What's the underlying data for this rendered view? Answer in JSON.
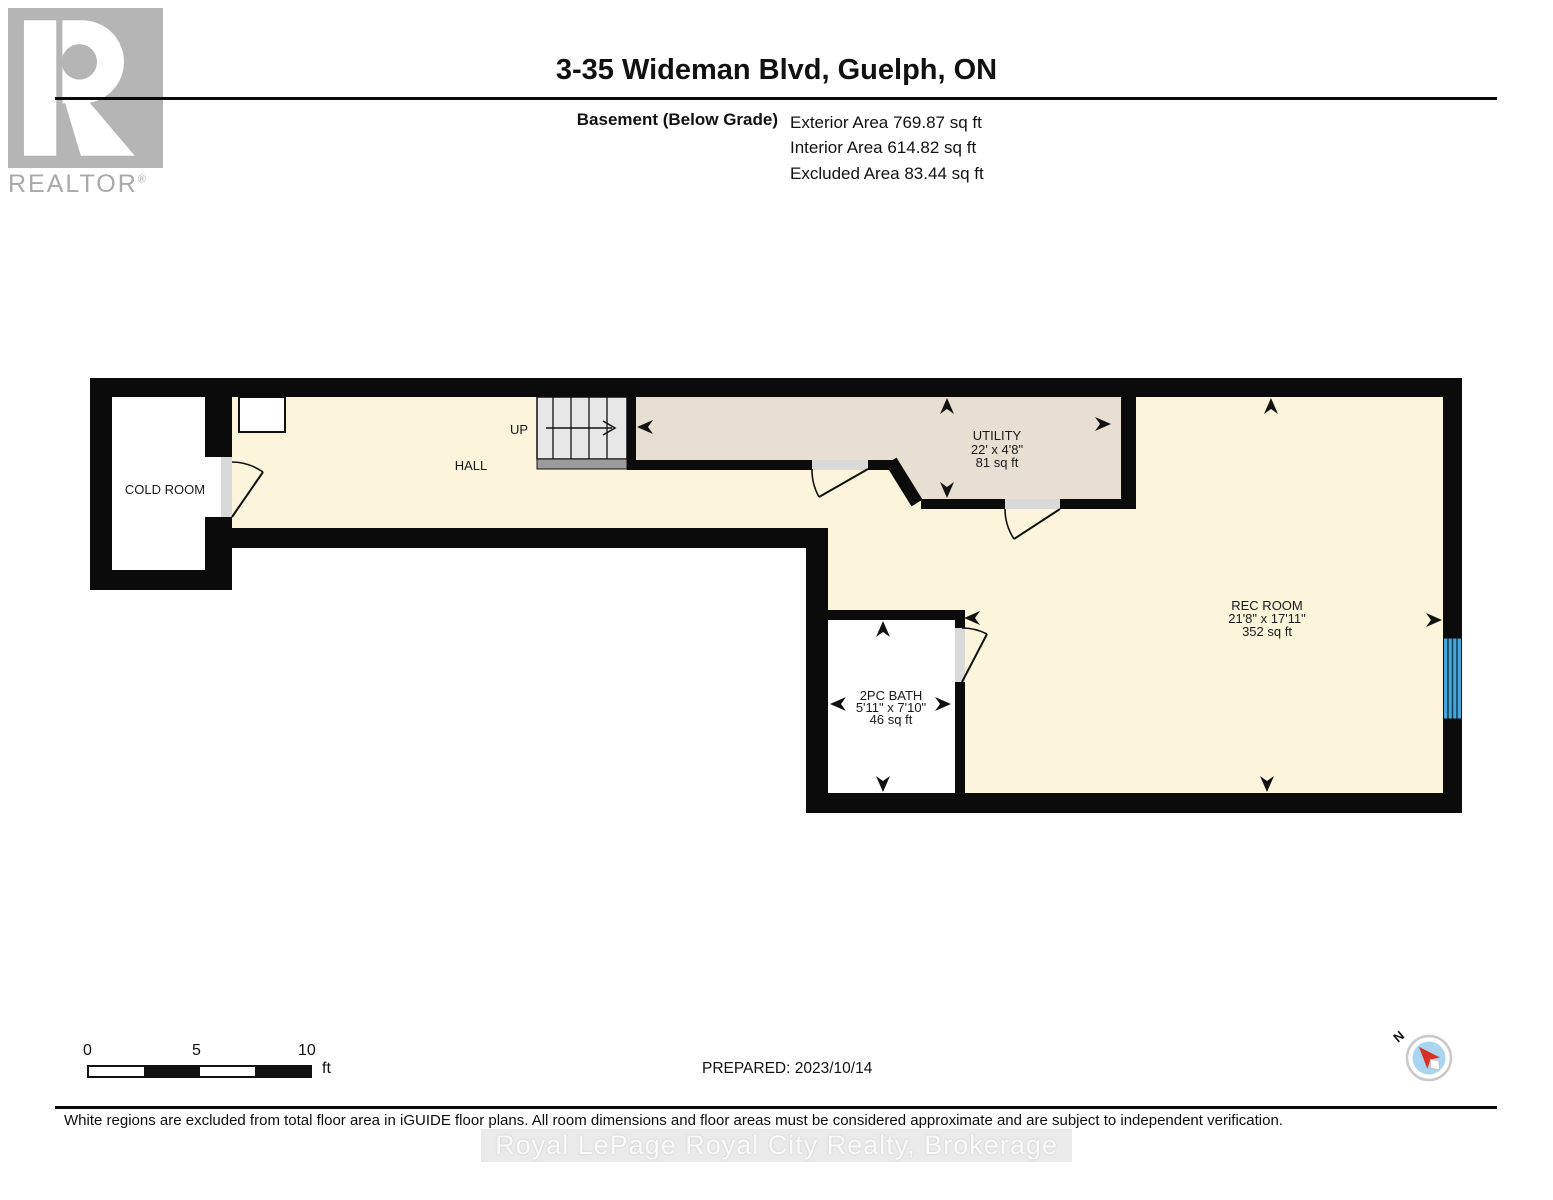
{
  "logo": {
    "text": "REALTOR",
    "reg": "®"
  },
  "header": {
    "title": "3-35 Wideman Blvd, Guelph, ON",
    "floor_label": "Basement (Below Grade)",
    "area_lines": [
      "Exterior Area 769.87 sq ft",
      "Interior Area 614.82 sq ft",
      "Excluded Area 83.44 sq ft"
    ]
  },
  "plan": {
    "rooms": {
      "cold_room": {
        "name": "COLD ROOM"
      },
      "hall": {
        "name": "HALL"
      },
      "stairs": {
        "label": "UP"
      },
      "utility": {
        "name": "UTILITY",
        "dims": "22' x 4'8\"",
        "area": "81 sq ft"
      },
      "rec_room": {
        "name": "REC ROOM",
        "dims": "21'8\" x 17'11\"",
        "area": "352 sq ft"
      },
      "bath": {
        "name": "2PC BATH",
        "dims": "5'11\" x 7'10\"",
        "area": "46 sq ft"
      }
    },
    "colors": {
      "floor": "#fcf5dc",
      "utility_floor": "#e8dfd3",
      "wall": "#0b0b0b",
      "stairs": "#e7e7e7",
      "stair_base": "#9b9b9b",
      "window_blue": "#45a6db",
      "door_sill": "#d9d9d9",
      "compass_red": "#d93025",
      "compass_blue": "#aad5ef"
    }
  },
  "scale_bar": {
    "ticks": [
      "0",
      "5",
      "10"
    ],
    "unit": "ft"
  },
  "prepared_label": "PREPARED: 2023/10/14",
  "compass": {
    "north_label": "N"
  },
  "footer": {
    "disclaimer": "White regions are excluded from total floor area in iGUIDE floor plans. All room dimensions and floor areas must be considered approximate and are subject to independent verification.",
    "watermark": "Royal LePage Royal City Realty, Brokerage"
  }
}
